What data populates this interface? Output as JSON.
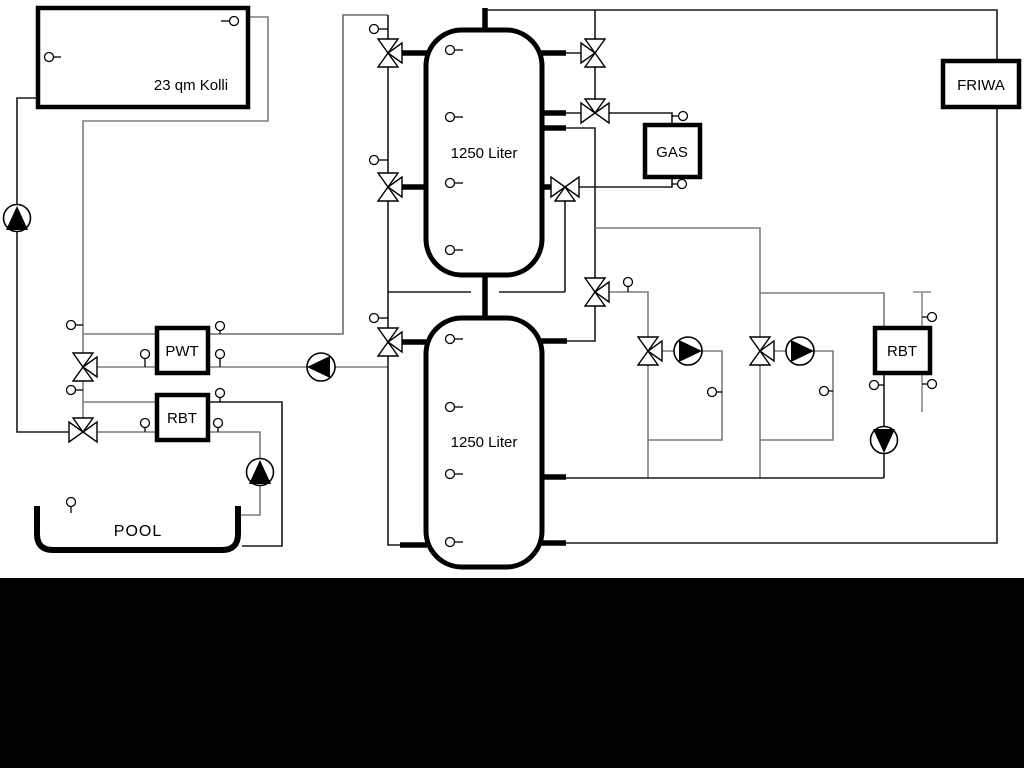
{
  "diagram": {
    "type": "hydraulic-heating-schematic",
    "labels": {
      "collector": "23 qm Kolli",
      "tank_upper": "1250 Liter",
      "tank_lower": "1250 Liter",
      "gas": "GAS",
      "friwa": "FRIWA",
      "pwt": "PWT",
      "rbt_left": "RBT",
      "rbt_right": "RBT",
      "pool": "POOL"
    },
    "colors": {
      "line_dark": "#1a1a1a",
      "line_gray": "#7d7d7d",
      "symbol": "#000000",
      "canvas": "#ffffff",
      "letterbox": "#000000"
    }
  }
}
